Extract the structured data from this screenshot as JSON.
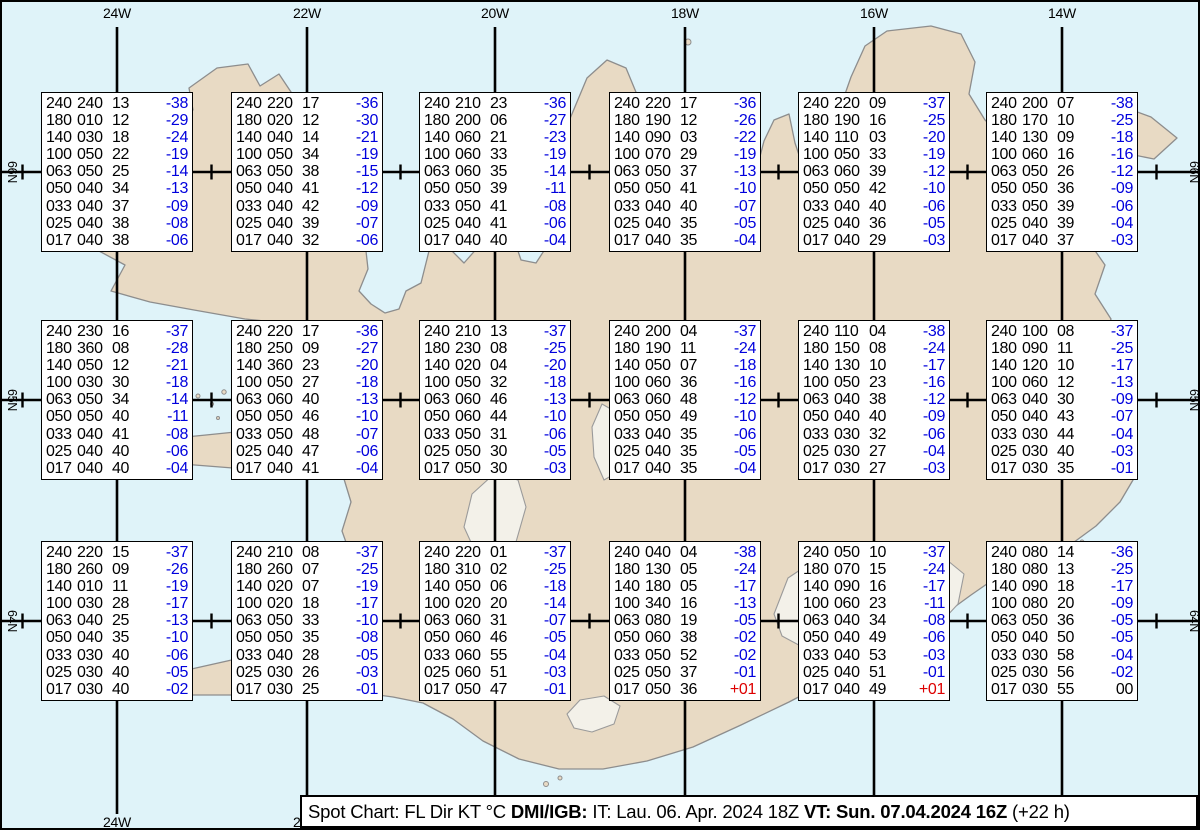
{
  "grid": {
    "lon_labels": [
      "24W",
      "22W",
      "20W",
      "18W",
      "16W",
      "14W"
    ],
    "lat_labels": [
      "66N",
      "65N",
      "64N"
    ]
  },
  "levels": [
    "240",
    "180",
    "140",
    "100",
    "063",
    "050",
    "033",
    "025",
    "017"
  ],
  "stations": [
    {
      "lon": "24W",
      "lat": "66N",
      "col": 0,
      "row": 0,
      "rows": [
        [
          "240",
          "240",
          "13",
          "-38"
        ],
        [
          "180",
          "010",
          "12",
          "-29"
        ],
        [
          "140",
          "030",
          "18",
          "-24"
        ],
        [
          "100",
          "050",
          "22",
          "-19"
        ],
        [
          "063",
          "050",
          "25",
          "-14"
        ],
        [
          "050",
          "040",
          "34",
          "-13"
        ],
        [
          "033",
          "040",
          "37",
          "-09"
        ],
        [
          "025",
          "040",
          "38",
          "-08"
        ],
        [
          "017",
          "040",
          "38",
          "-06"
        ]
      ]
    },
    {
      "lon": "22W",
      "lat": "66N",
      "col": 1,
      "row": 0,
      "rows": [
        [
          "240",
          "220",
          "17",
          "-36"
        ],
        [
          "180",
          "020",
          "12",
          "-30"
        ],
        [
          "140",
          "040",
          "14",
          "-21"
        ],
        [
          "100",
          "050",
          "34",
          "-19"
        ],
        [
          "063",
          "050",
          "38",
          "-15"
        ],
        [
          "050",
          "040",
          "41",
          "-12"
        ],
        [
          "033",
          "040",
          "42",
          "-09"
        ],
        [
          "025",
          "040",
          "39",
          "-07"
        ],
        [
          "017",
          "040",
          "32",
          "-06"
        ]
      ]
    },
    {
      "lon": "20W",
      "lat": "66N",
      "col": 2,
      "row": 0,
      "rows": [
        [
          "240",
          "210",
          "23",
          "-36"
        ],
        [
          "180",
          "200",
          "06",
          "-27"
        ],
        [
          "140",
          "060",
          "21",
          "-23"
        ],
        [
          "100",
          "060",
          "33",
          "-19"
        ],
        [
          "063",
          "060",
          "35",
          "-14"
        ],
        [
          "050",
          "050",
          "39",
          "-11"
        ],
        [
          "033",
          "050",
          "41",
          "-08"
        ],
        [
          "025",
          "040",
          "41",
          "-06"
        ],
        [
          "017",
          "040",
          "40",
          "-04"
        ]
      ]
    },
    {
      "lon": "18W",
      "lat": "66N",
      "col": 3,
      "row": 0,
      "rows": [
        [
          "240",
          "220",
          "17",
          "-36"
        ],
        [
          "180",
          "190",
          "12",
          "-26"
        ],
        [
          "140",
          "090",
          "03",
          "-22"
        ],
        [
          "100",
          "070",
          "29",
          "-19"
        ],
        [
          "063",
          "050",
          "37",
          "-13"
        ],
        [
          "050",
          "050",
          "41",
          "-10"
        ],
        [
          "033",
          "040",
          "40",
          "-07"
        ],
        [
          "025",
          "040",
          "35",
          "-05"
        ],
        [
          "017",
          "040",
          "35",
          "-04"
        ]
      ]
    },
    {
      "lon": "16W",
      "lat": "66N",
      "col": 4,
      "row": 0,
      "rows": [
        [
          "240",
          "220",
          "09",
          "-37"
        ],
        [
          "180",
          "190",
          "16",
          "-25"
        ],
        [
          "140",
          "110",
          "03",
          "-20"
        ],
        [
          "100",
          "050",
          "33",
          "-19"
        ],
        [
          "063",
          "060",
          "39",
          "-12"
        ],
        [
          "050",
          "050",
          "42",
          "-10"
        ],
        [
          "033",
          "040",
          "40",
          "-06"
        ],
        [
          "025",
          "040",
          "36",
          "-05"
        ],
        [
          "017",
          "040",
          "29",
          "-03"
        ]
      ]
    },
    {
      "lon": "14W",
      "lat": "66N",
      "col": 5,
      "row": 0,
      "rows": [
        [
          "240",
          "200",
          "07",
          "-38"
        ],
        [
          "180",
          "170",
          "10",
          "-25"
        ],
        [
          "140",
          "130",
          "09",
          "-18"
        ],
        [
          "100",
          "060",
          "16",
          "-16"
        ],
        [
          "063",
          "050",
          "26",
          "-12"
        ],
        [
          "050",
          "050",
          "36",
          "-09"
        ],
        [
          "033",
          "050",
          "39",
          "-06"
        ],
        [
          "025",
          "040",
          "39",
          "-04"
        ],
        [
          "017",
          "040",
          "37",
          "-03"
        ]
      ]
    },
    {
      "lon": "24W",
      "lat": "65N",
      "col": 0,
      "row": 1,
      "rows": [
        [
          "240",
          "230",
          "16",
          "-37"
        ],
        [
          "180",
          "360",
          "08",
          "-28"
        ],
        [
          "140",
          "050",
          "12",
          "-21"
        ],
        [
          "100",
          "030",
          "30",
          "-18"
        ],
        [
          "063",
          "050",
          "34",
          "-14"
        ],
        [
          "050",
          "050",
          "40",
          "-11"
        ],
        [
          "033",
          "040",
          "41",
          "-08"
        ],
        [
          "025",
          "040",
          "40",
          "-06"
        ],
        [
          "017",
          "040",
          "40",
          "-04"
        ]
      ]
    },
    {
      "lon": "22W",
      "lat": "65N",
      "col": 1,
      "row": 1,
      "rows": [
        [
          "240",
          "220",
          "17",
          "-36"
        ],
        [
          "180",
          "250",
          "09",
          "-27"
        ],
        [
          "140",
          "360",
          "23",
          "-20"
        ],
        [
          "100",
          "050",
          "27",
          "-18"
        ],
        [
          "063",
          "060",
          "40",
          "-13"
        ],
        [
          "050",
          "050",
          "46",
          "-10"
        ],
        [
          "033",
          "050",
          "48",
          "-07"
        ],
        [
          "025",
          "040",
          "47",
          "-06"
        ],
        [
          "017",
          "040",
          "41",
          "-04"
        ]
      ]
    },
    {
      "lon": "20W",
      "lat": "65N",
      "col": 2,
      "row": 1,
      "rows": [
        [
          "240",
          "210",
          "13",
          "-37"
        ],
        [
          "180",
          "230",
          "08",
          "-25"
        ],
        [
          "140",
          "020",
          "04",
          "-20"
        ],
        [
          "100",
          "050",
          "32",
          "-18"
        ],
        [
          "063",
          "060",
          "46",
          "-13"
        ],
        [
          "050",
          "060",
          "44",
          "-10"
        ],
        [
          "033",
          "050",
          "31",
          "-06"
        ],
        [
          "025",
          "050",
          "30",
          "-05"
        ],
        [
          "017",
          "050",
          "30",
          "-03"
        ]
      ]
    },
    {
      "lon": "18W",
      "lat": "65N",
      "col": 3,
      "row": 1,
      "rows": [
        [
          "240",
          "200",
          "04",
          "-37"
        ],
        [
          "180",
          "190",
          "11",
          "-24"
        ],
        [
          "140",
          "050",
          "07",
          "-18"
        ],
        [
          "100",
          "060",
          "36",
          "-16"
        ],
        [
          "063",
          "060",
          "48",
          "-12"
        ],
        [
          "050",
          "050",
          "49",
          "-10"
        ],
        [
          "033",
          "040",
          "35",
          "-06"
        ],
        [
          "025",
          "040",
          "35",
          "-05"
        ],
        [
          "017",
          "040",
          "35",
          "-04"
        ]
      ]
    },
    {
      "lon": "16W",
      "lat": "65N",
      "col": 4,
      "row": 1,
      "rows": [
        [
          "240",
          "110",
          "04",
          "-38"
        ],
        [
          "180",
          "150",
          "08",
          "-24"
        ],
        [
          "140",
          "130",
          "10",
          "-17"
        ],
        [
          "100",
          "050",
          "23",
          "-16"
        ],
        [
          "063",
          "040",
          "38",
          "-12"
        ],
        [
          "050",
          "040",
          "40",
          "-09"
        ],
        [
          "033",
          "030",
          "32",
          "-06"
        ],
        [
          "025",
          "030",
          "27",
          "-04"
        ],
        [
          "017",
          "030",
          "27",
          "-03"
        ]
      ]
    },
    {
      "lon": "14W",
      "lat": "65N",
      "col": 5,
      "row": 1,
      "rows": [
        [
          "240",
          "100",
          "08",
          "-37"
        ],
        [
          "180",
          "090",
          "11",
          "-25"
        ],
        [
          "140",
          "120",
          "10",
          "-17"
        ],
        [
          "100",
          "060",
          "12",
          "-13"
        ],
        [
          "063",
          "040",
          "30",
          "-09"
        ],
        [
          "050",
          "040",
          "43",
          "-07"
        ],
        [
          "033",
          "030",
          "44",
          "-04"
        ],
        [
          "025",
          "030",
          "40",
          "-03"
        ],
        [
          "017",
          "030",
          "35",
          "-01"
        ]
      ]
    },
    {
      "lon": "24W",
      "lat": "64N",
      "col": 0,
      "row": 2,
      "rows": [
        [
          "240",
          "220",
          "15",
          "-37"
        ],
        [
          "180",
          "260",
          "09",
          "-26"
        ],
        [
          "140",
          "010",
          "11",
          "-19"
        ],
        [
          "100",
          "030",
          "28",
          "-17"
        ],
        [
          "063",
          "040",
          "25",
          "-13"
        ],
        [
          "050",
          "040",
          "35",
          "-10"
        ],
        [
          "033",
          "030",
          "40",
          "-06"
        ],
        [
          "025",
          "030",
          "40",
          "-05"
        ],
        [
          "017",
          "030",
          "40",
          "-02"
        ]
      ]
    },
    {
      "lon": "22W",
      "lat": "64N",
      "col": 1,
      "row": 2,
      "rows": [
        [
          "240",
          "210",
          "08",
          "-37"
        ],
        [
          "180",
          "260",
          "07",
          "-25"
        ],
        [
          "140",
          "020",
          "07",
          "-19"
        ],
        [
          "100",
          "020",
          "18",
          "-17"
        ],
        [
          "063",
          "050",
          "33",
          "-10"
        ],
        [
          "050",
          "050",
          "35",
          "-08"
        ],
        [
          "033",
          "040",
          "28",
          "-05"
        ],
        [
          "025",
          "030",
          "26",
          "-03"
        ],
        [
          "017",
          "030",
          "25",
          "-01"
        ]
      ]
    },
    {
      "lon": "20W",
      "lat": "64N",
      "col": 2,
      "row": 2,
      "rows": [
        [
          "240",
          "220",
          "01",
          "-37"
        ],
        [
          "180",
          "310",
          "02",
          "-25"
        ],
        [
          "140",
          "050",
          "06",
          "-18"
        ],
        [
          "100",
          "020",
          "20",
          "-14"
        ],
        [
          "063",
          "060",
          "31",
          "-07"
        ],
        [
          "050",
          "060",
          "46",
          "-05"
        ],
        [
          "033",
          "060",
          "55",
          "-04"
        ],
        [
          "025",
          "060",
          "51",
          "-03"
        ],
        [
          "017",
          "050",
          "47",
          "-01"
        ]
      ]
    },
    {
      "lon": "18W",
      "lat": "64N",
      "col": 3,
      "row": 2,
      "rows": [
        [
          "240",
          "040",
          "04",
          "-38"
        ],
        [
          "180",
          "130",
          "05",
          "-24"
        ],
        [
          "140",
          "180",
          "05",
          "-17"
        ],
        [
          "100",
          "340",
          "16",
          "-13"
        ],
        [
          "063",
          "080",
          "19",
          "-05"
        ],
        [
          "050",
          "060",
          "38",
          "-02"
        ],
        [
          "033",
          "050",
          "52",
          "-02"
        ],
        [
          "025",
          "050",
          "37",
          "-01"
        ],
        [
          "017",
          "050",
          "36",
          "+01"
        ]
      ]
    },
    {
      "lon": "16W",
      "lat": "64N",
      "col": 4,
      "row": 2,
      "rows": [
        [
          "240",
          "050",
          "10",
          "-37"
        ],
        [
          "180",
          "070",
          "15",
          "-24"
        ],
        [
          "140",
          "090",
          "16",
          "-17"
        ],
        [
          "100",
          "060",
          "23",
          "-11"
        ],
        [
          "063",
          "040",
          "34",
          "-08"
        ],
        [
          "050",
          "040",
          "49",
          "-06"
        ],
        [
          "033",
          "040",
          "53",
          "-03"
        ],
        [
          "025",
          "040",
          "51",
          "-01"
        ],
        [
          "017",
          "040",
          "49",
          "+01"
        ]
      ]
    },
    {
      "lon": "14W",
      "lat": "64N",
      "col": 5,
      "row": 2,
      "rows": [
        [
          "240",
          "080",
          "14",
          "-36"
        ],
        [
          "180",
          "080",
          "13",
          "-25"
        ],
        [
          "140",
          "090",
          "18",
          "-17"
        ],
        [
          "100",
          "080",
          "20",
          "-09"
        ],
        [
          "063",
          "050",
          "36",
          "-05"
        ],
        [
          "050",
          "040",
          "50",
          "-05"
        ],
        [
          "033",
          "030",
          "58",
          "-04"
        ],
        [
          "025",
          "030",
          "56",
          "-02"
        ],
        [
          "017",
          "030",
          "55",
          "00"
        ]
      ]
    }
  ],
  "footer": {
    "segments": [
      {
        "text": "Spot Chart: FL Dir KT °C ",
        "bold": false
      },
      {
        "text": "DMI/IGB:",
        "bold": true
      },
      {
        "text": " IT: Lau. 06. Apr. 2024 18Z ",
        "bold": false
      },
      {
        "text": "VT: Sun. 07.04.2024 16Z",
        "bold": true
      },
      {
        "text": " (+22 h)",
        "bold": false
      }
    ]
  },
  "colors": {
    "ocean": "#dff3f9",
    "land": "#e8dac4",
    "coast": "#8d8d8d",
    "glacier": "#f3f1e9",
    "temp_negative": "#0000dd",
    "temp_positive": "#dd0000",
    "temp_zero": "#000000",
    "grid": "#000000"
  }
}
